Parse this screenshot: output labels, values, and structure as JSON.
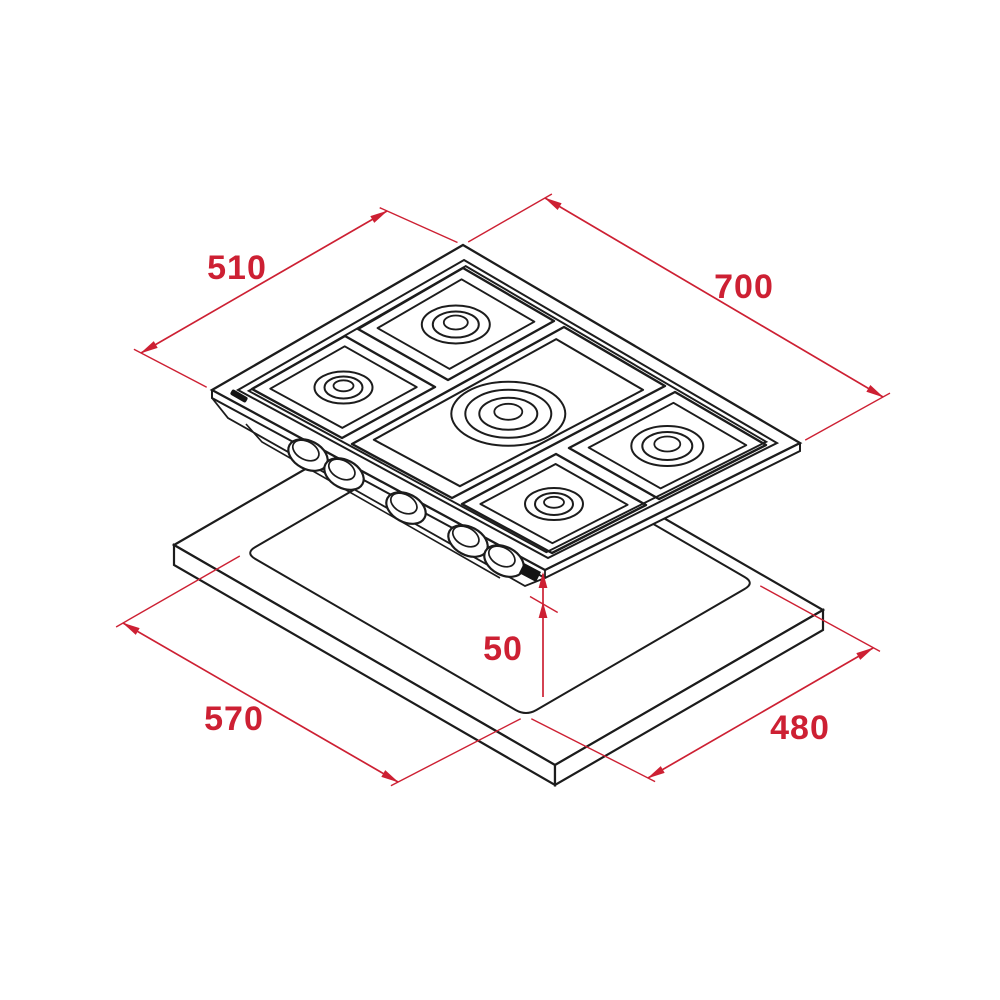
{
  "diagram": {
    "title": "gas-hob-installation-dimension-drawing",
    "accent_color": "#cd2033",
    "line_color": "#1c1c1c",
    "brand_logo": "TEKA",
    "dimensions": {
      "hob_depth": "510",
      "hob_width": "700",
      "cutout_width": "570",
      "cutout_depth": "480",
      "clearance": "50"
    }
  }
}
